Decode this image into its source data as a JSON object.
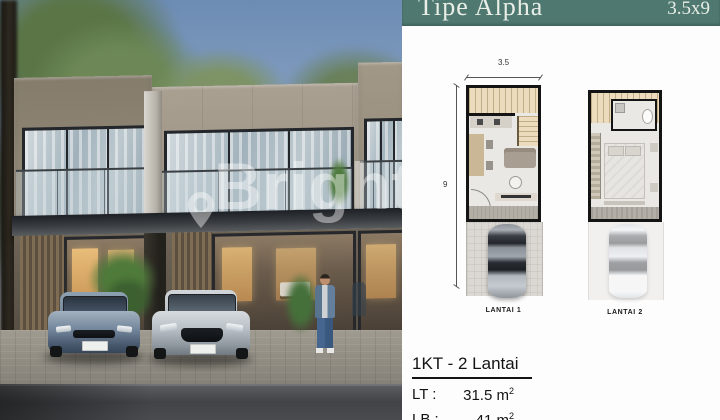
{
  "header": {
    "title": "Tipe Alpha",
    "size": "3.5x9"
  },
  "photo": {
    "watermark_text": "Brighton"
  },
  "floorplan1": {
    "width_dim": "3.5",
    "height_dim": "9",
    "label": "LANTAI 1"
  },
  "floorplan2": {
    "label": "LANTAI 2"
  },
  "specs": {
    "title": "1KT - 2 Lantai",
    "rows": [
      {
        "label": "LT :",
        "value": "31.5 m",
        "sup": "2"
      },
      {
        "label": "LB :",
        "value": "41 m",
        "sup": "2"
      }
    ]
  },
  "colors": {
    "header_bg": "#4f7871",
    "header_text": "#e9efe7",
    "plan_wall": "#141414"
  }
}
